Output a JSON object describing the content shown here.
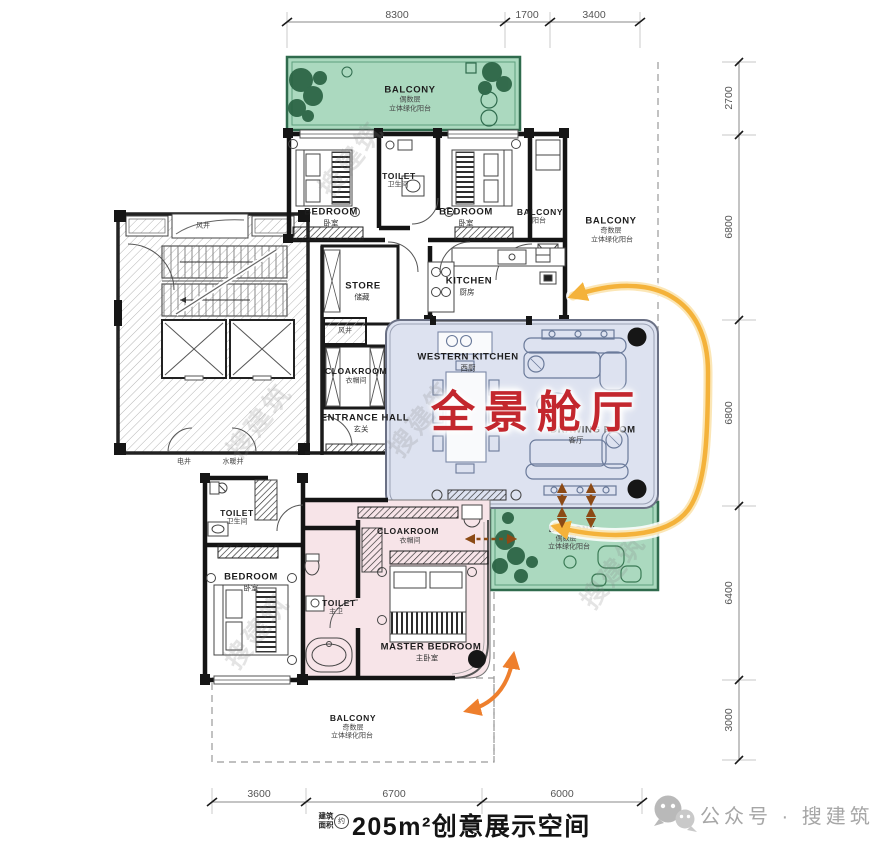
{
  "dims": {
    "top": [
      "8300",
      "1700",
      "3400"
    ],
    "right": [
      "2700",
      "6800",
      "6800",
      "6400",
      "3000"
    ],
    "bottom": [
      "3600",
      "6700",
      "6000"
    ]
  },
  "rooms": {
    "balcony_top": {
      "en": "BALCONY",
      "l1": "偶数层",
      "l2": "立体绿化阳台"
    },
    "bedroom_a": {
      "en": "BEDROOM",
      "zh": "卧室"
    },
    "toilet_a": {
      "en": "TOILET",
      "zh": "卫生间"
    },
    "bedroom_b": {
      "en": "BEDROOM",
      "zh": "卧室"
    },
    "balcony_small": {
      "en": "BALCONY",
      "zh": "阳台"
    },
    "balcony_right": {
      "en": "BALCONY",
      "l1": "奇数层",
      "l2": "立体绿化阳台"
    },
    "kitchen": {
      "en": "KITCHEN",
      "zh": "厨房"
    },
    "store": {
      "en": "STORE",
      "zh": "储藏"
    },
    "shaft_wind_a": "风井",
    "shaft_wind_b": "风井",
    "shaft_elec": "电井",
    "shaft_plumb": "水暖井",
    "cloakroom_a": {
      "en": "CLOAKROOM",
      "zh": "衣帽间"
    },
    "entrance": {
      "en": "ENTRANCE HALL",
      "zh": "玄关"
    },
    "western_kitchen": {
      "en": "WESTERN KITCHEN",
      "zh": "西厨"
    },
    "drawing_room": {
      "en": "DRAWING ROOM",
      "zh": "客厅"
    },
    "balcony_green_b": {
      "en": "BALCONY",
      "l1": "偶数层",
      "l2": "立体绿化阳台"
    },
    "cloakroom_b": {
      "en": "CLOAKROOM",
      "zh": "衣帽间"
    },
    "toilet_master": {
      "en": "TOILET",
      "zh": "主卫"
    },
    "master_bedroom": {
      "en": "MASTER BEDROOM",
      "zh": "主卧室"
    },
    "toilet_b": {
      "en": "TOILET",
      "zh": "卫生间"
    },
    "bedroom_c": {
      "en": "BEDROOM",
      "zh": "卧室"
    },
    "balcony_bottom": {
      "en": "BALCONY",
      "l1": "奇数层",
      "l2": "立体绿化阳台"
    }
  },
  "annotation": {
    "highlight": "全景舱厅",
    "highlight_color": "#c3272e"
  },
  "footer": {
    "area_l1": "建筑",
    "area_l2": "面积",
    "approx": "约",
    "title": "205m²创意展示空间"
  },
  "watermark": {
    "wechat": "公众号 · 搜建筑",
    "diagonal": "搜建筑"
  },
  "colors": {
    "green": "#abd9bf",
    "blue": "#dde2f0",
    "pink": "#f7e4e8",
    "yellow_arrow": "#f4b23a",
    "brown_arrow": "#8c4a15",
    "orange_arrow": "#ee7f2d"
  }
}
